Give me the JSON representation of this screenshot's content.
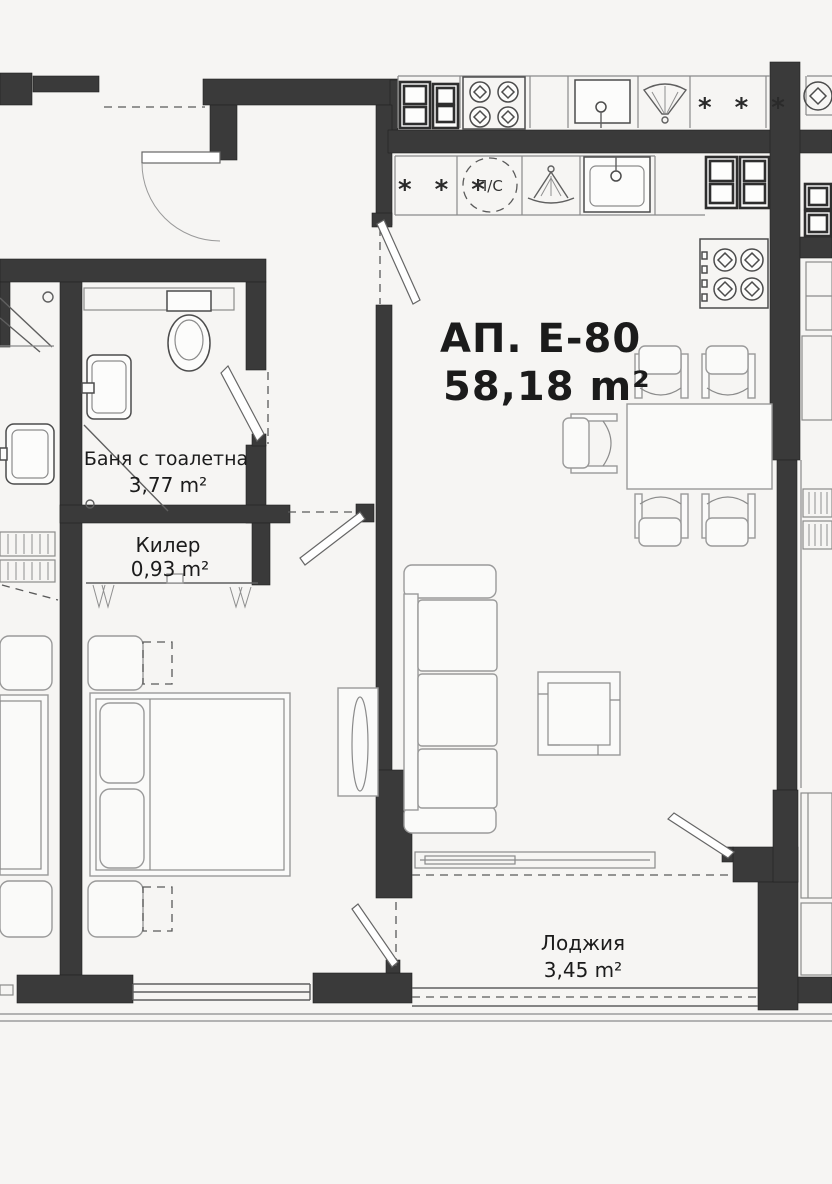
{
  "plan": {
    "title": "АП. Е-80",
    "title_area": "58,18 m²",
    "rooms": [
      {
        "name": "Баня с тоалетна",
        "area": "3,77 m²"
      },
      {
        "name": "Килер",
        "area": "0,93 m²"
      },
      {
        "name": "Лоджия",
        "area": "3,45 m²"
      }
    ],
    "symbols": {
      "freezer_top": "* * *",
      "freezer_kitchen": "* * *",
      "washer_dryer": "П/С"
    },
    "colors": {
      "wall": "#3a3a3a",
      "line": "#8a8a8a",
      "background": "#f6f5f3",
      "text": "#1b1b1b"
    }
  }
}
